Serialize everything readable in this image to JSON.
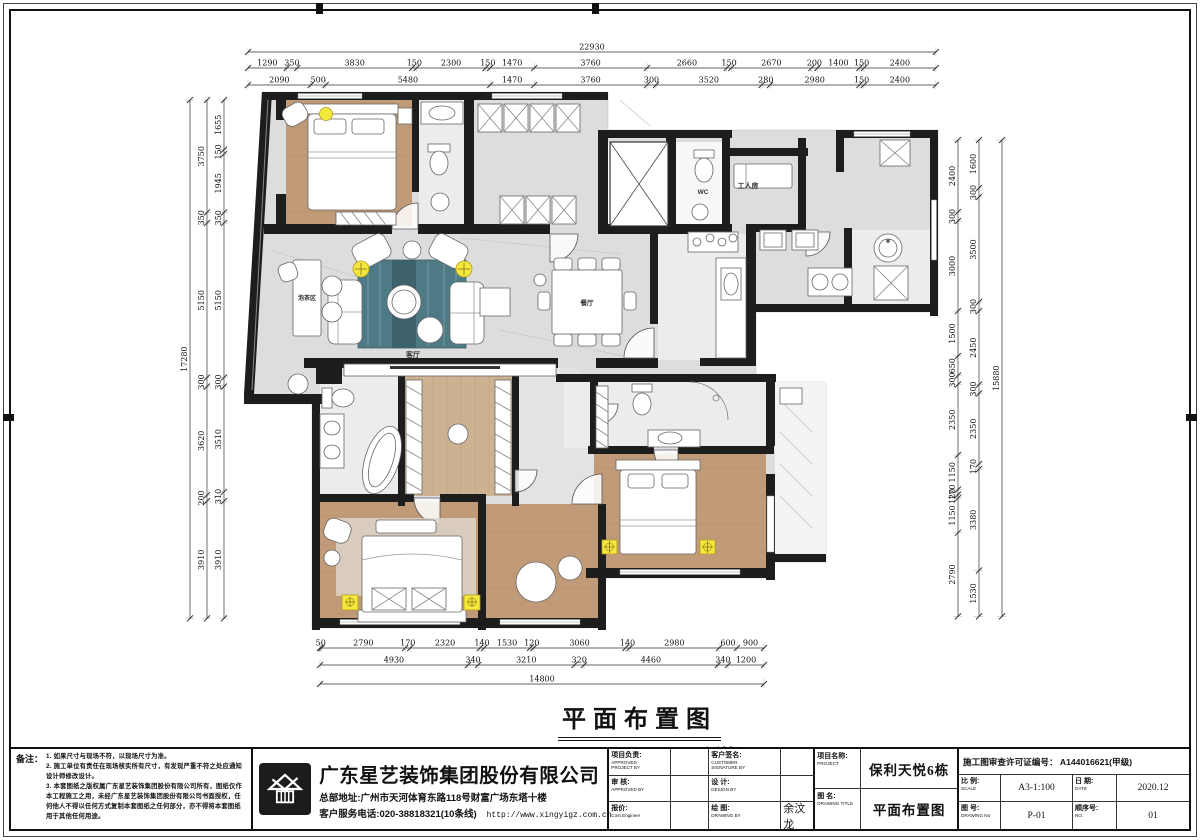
{
  "sheet": {
    "title": "平面布置图",
    "scale_label": "1:100"
  },
  "colors": {
    "wall": "#1d1d1d",
    "wood": "#c19b77",
    "wood_light": "#cdb292",
    "marble": "#dcdddc",
    "tile": "#ececec",
    "rug": "#4e7a85",
    "lamp": "#f2e93c"
  },
  "plan": {
    "labels": {
      "worker_room": "工人房",
      "wc": "WC",
      "living": "客厅",
      "dining": "餐厅",
      "tea_area": "泡茶区"
    }
  },
  "dimensions": {
    "top": {
      "total": 22930,
      "row1": [
        1290,
        350,
        3830,
        150,
        2300,
        150,
        1470,
        3760,
        2660,
        150,
        2670,
        200,
        1400,
        150,
        2400
      ],
      "row2": [
        2090,
        500,
        5480,
        1470,
        3760,
        300,
        3520,
        280,
        2980,
        150,
        2400
      ]
    },
    "left": {
      "total": 17280,
      "mid": [
        3750,
        350,
        5150,
        300,
        3620,
        200,
        3910
      ],
      "inner": [
        1655,
        150,
        1945,
        350,
        5150,
        300,
        3510,
        310,
        3910
      ]
    },
    "right": {
      "total": 15880,
      "inner": [
        2400,
        300,
        3000,
        1500,
        650,
        300,
        2350,
        1150,
        170,
        120,
        1150,
        2790
      ],
      "outer": [
        1600,
        300,
        3500,
        300,
        2450,
        300,
        2350,
        170,
        3380,
        1530
      ]
    },
    "bottom": {
      "total": 14800,
      "row1": [
        50,
        2790,
        170,
        2320,
        140,
        1530,
        120,
        3060,
        140,
        2980,
        600,
        900
      ],
      "row2": [
        4930,
        340,
        3210,
        320,
        4460,
        340,
        1200
      ]
    }
  },
  "notes": {
    "heading": "备注：",
    "items": [
      "1. 如果尺寸与现场不符，以现场尺寸为准。",
      "2. 施工单位有责任在现场核实所有尺寸，有发现严重不符之处应通知设计师修改设计。",
      "3. 本套图纸之版权属广东星艺装饰集团股份有限公司所有，图纸仅作本工程施工之用，未经广东星艺装饰集团股份有限公司书面授权，任何他人不得以任何方式复制本套图纸之任何部分，亦不得将本套图纸用于其他任何用途。"
    ]
  },
  "company": {
    "name": "广东星艺装饰集团股份有限公司",
    "address": "总部地址:广州市天河体育东路118号财富广场东塔十楼",
    "phone": "客户服务电话:020-38818321(10条线)",
    "website": "http://www.xingyigz.com.cn"
  },
  "titleblock": {
    "fields": [
      {
        "label": "项目负责:",
        "sub": "APPROVED\nPROJECT BY",
        "value": ""
      },
      {
        "label": "客户签名:",
        "sub": "CUSTOMER\nSIGNATURE BY",
        "value": ""
      },
      {
        "label": "审 核:",
        "sub": "APPROVED BY",
        "value": ""
      },
      {
        "label": "设 计:",
        "sub": "DESIGN BY",
        "value": ""
      },
      {
        "label": "报价:",
        "sub": "Cost Engineer",
        "value": ""
      },
      {
        "label": "绘 图:",
        "sub": "DRAWING BY",
        "value": "余汶龙"
      }
    ],
    "project_label": "项目名称:",
    "project_sub": "PROJECT",
    "project_value": "保利天悦6栋",
    "drawing_label": "图 名:",
    "drawing_sub": "DRAWING  TITLE",
    "drawing_value": "平面布置图",
    "permit": "施工图审查许可证编号： A144016621(甲级)",
    "scale_label": "比 例:",
    "scale_sub": "SCALE",
    "scale_value": "A3-1:100",
    "date_label": "日 期:",
    "date_sub": "DATE",
    "date_value": "2020.12",
    "no_label": "图 号:",
    "no_sub": "DRAWING No",
    "no_value": "P-01",
    "seq_label": "顺序号:",
    "seq_sub": "NO.",
    "seq_value": "01"
  }
}
